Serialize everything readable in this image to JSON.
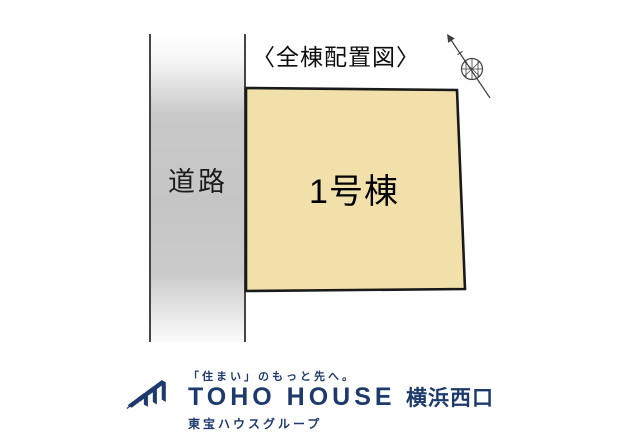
{
  "diagram": {
    "title": "〈全棟配置図〉",
    "road_label": "道路",
    "plot_label": "1号棟",
    "colors": {
      "plot_fill": "#f2e0ab",
      "plot_border": "#1a1a1a",
      "road_gray": "#c6c6c6",
      "boundary_line": "#454545"
    },
    "icons": {
      "compass": "north-arrow-icon"
    }
  },
  "footer": {
    "tagline": "「住まい」のもっと先へ。",
    "brand": "TOHO HOUSE",
    "branch": "横浜西口",
    "group": "東宝ハウスグループ",
    "brand_color": "#1d3a6d",
    "icons": {
      "logo": "toho-house-logo-icon"
    }
  }
}
